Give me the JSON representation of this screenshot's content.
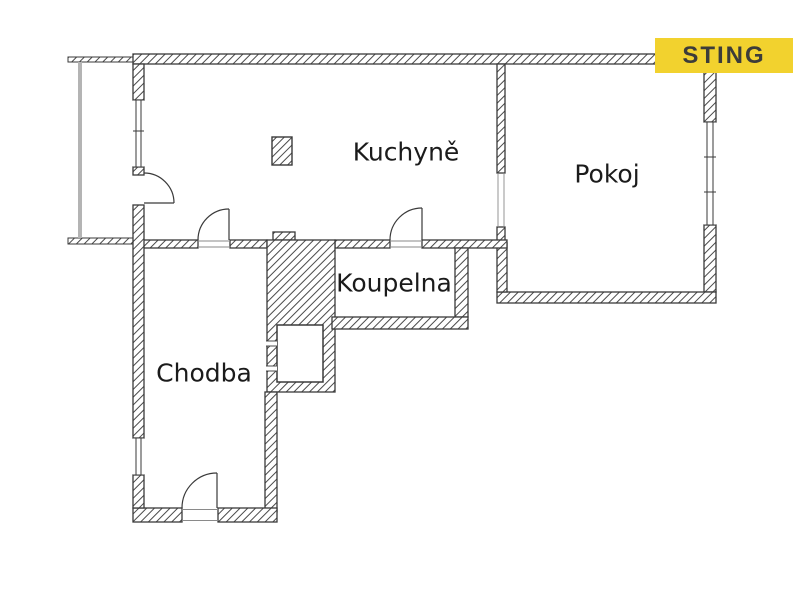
{
  "brand": {
    "logo_text": "STING",
    "logo_bg_color": "#F2D22E",
    "logo_text_color": "#3C3C3A"
  },
  "floor_plan": {
    "type": "apartment-floor-plan",
    "rooms": [
      {
        "id": "kuchyne",
        "label": "Kuchyně"
      },
      {
        "id": "pokoj",
        "label": "Pokoj"
      },
      {
        "id": "koupelna",
        "label": "Koupelna"
      },
      {
        "id": "chodba",
        "label": "Chodba"
      }
    ],
    "features": [
      "balcony-with-gray-railing",
      "hatched-column-in-kitchen",
      "shaft-square",
      "four-door-swing-arcs",
      "three-windows",
      "wall-opening-kitchen-to-pokoj"
    ],
    "colors": {
      "wall_line": "#3a3a3a",
      "wall_hatch": "#4a4a4a",
      "balcony_rail": "#b4b4b4",
      "label_text": "#1b1b1b",
      "background": "#ffffff"
    }
  }
}
